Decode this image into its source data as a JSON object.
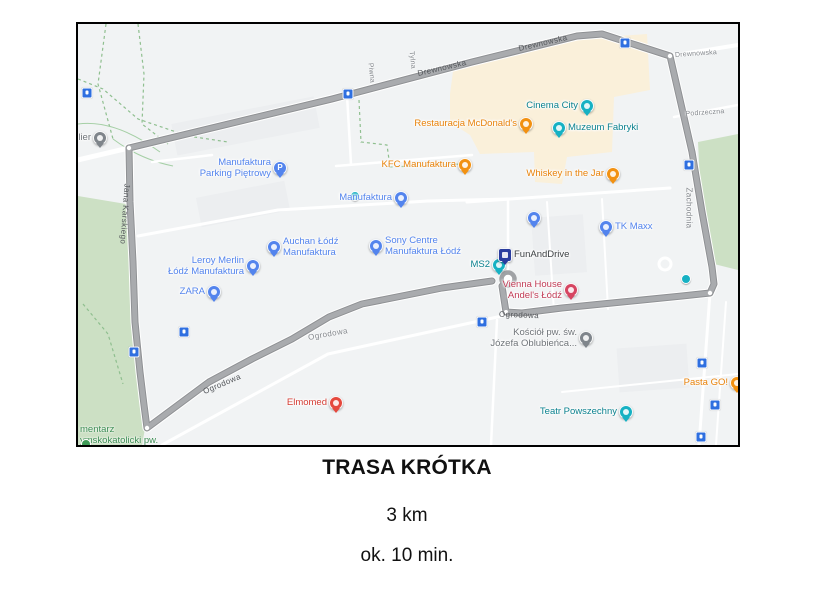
{
  "captions": {
    "title": "TRASA KRÓTKA",
    "distance": "3 km",
    "duration": "ok. 10 min."
  },
  "map": {
    "colors": {
      "background": "#f1f3f4",
      "route": "#a9abae",
      "route_casing": "#8f9194",
      "park_green": "#cce0c4",
      "commercial_cream": "#faf0da",
      "transit_blue": "#2f6fe0",
      "poi_teal": "#16b1c3",
      "poi_blue": "#5384ed",
      "poi_orange": "#f29111",
      "poi_red": "#e5483d",
      "poi_crimson": "#d64561",
      "poi_gray": "#7f858b",
      "poi_navy": "#2a3d9e",
      "poi_green": "#3f9b57"
    },
    "markers": [
      {
        "id": "atelier",
        "lines": [
          "Atelier"
        ],
        "color": "#7f858b",
        "text_color": "#6f7479",
        "x": 22,
        "y": 126,
        "side": "left"
      },
      {
        "id": "manufaktura-parking-pietrowy",
        "lines": [
          "Manufaktura",
          "Parking Piętrowy"
        ],
        "color": "#5384ed",
        "text_color": "#5384ed",
        "x": 202,
        "y": 156,
        "side": "left",
        "glyph": "P"
      },
      {
        "id": "cinema-city",
        "lines": [
          "Cinema City"
        ],
        "color": "#16b1c3",
        "text_color": "#0c828f",
        "x": 509,
        "y": 94,
        "side": "left"
      },
      {
        "id": "muzeum-fabryki",
        "lines": [
          "Muzeum Fabryki"
        ],
        "color": "#16b1c3",
        "text_color": "#0c828f",
        "x": 481,
        "y": 116,
        "side": "right"
      },
      {
        "id": "restauracja-mcdonalds",
        "lines": [
          "Restauracja McDonald's"
        ],
        "color": "#f29111",
        "text_color": "#e8820a",
        "x": 448,
        "y": 112,
        "side": "left"
      },
      {
        "id": "kfc-manufaktura",
        "lines": [
          "KFC Manufaktura"
        ],
        "color": "#f29111",
        "text_color": "#e8820a",
        "x": 387,
        "y": 153,
        "side": "left"
      },
      {
        "id": "whiskey-in-the-jar",
        "lines": [
          "Whiskey in the Jar"
        ],
        "color": "#f29111",
        "text_color": "#e8820a",
        "x": 535,
        "y": 162,
        "side": "left"
      },
      {
        "id": "manufaktura",
        "lines": [
          "Manufaktura"
        ],
        "color": "#5384ed",
        "text_color": "#5384ed",
        "x": 323,
        "y": 186,
        "side": "left"
      },
      {
        "id": "auchan-lodz-manufaktura",
        "lines": [
          "Auchan Łódź",
          "Manufaktura"
        ],
        "color": "#5384ed",
        "text_color": "#5384ed",
        "x": 196,
        "y": 235,
        "side": "right"
      },
      {
        "id": "sony-centre-manufaktura-lodz",
        "lines": [
          "Sony Centre",
          "Manufaktura Łódź"
        ],
        "color": "#5384ed",
        "text_color": "#5384ed",
        "x": 298,
        "y": 234,
        "side": "right"
      },
      {
        "id": "leroy-merlin-lodz-manufaktura",
        "lines": [
          "Leroy Merlin",
          "Łódź Manufaktura"
        ],
        "color": "#5384ed",
        "text_color": "#5384ed",
        "x": 175,
        "y": 254,
        "side": "left"
      },
      {
        "id": "zara",
        "lines": [
          "ZARA"
        ],
        "color": "#5384ed",
        "text_color": "#5384ed",
        "x": 136,
        "y": 280,
        "side": "left"
      },
      {
        "id": "tk-maxx",
        "lines": [
          "TK Maxx"
        ],
        "color": "#5384ed",
        "text_color": "#5384ed",
        "x": 528,
        "y": 215,
        "side": "right"
      },
      {
        "id": "unlabeled-shop",
        "lines": null,
        "color": "#5384ed",
        "x": 456,
        "y": 206
      },
      {
        "id": "ms2",
        "lines": [
          "MS2"
        ],
        "color": "#16b1c3",
        "text_color": "#0c828f",
        "x": 421,
        "y": 253,
        "side": "left"
      },
      {
        "id": "funanddrive",
        "lines": [
          "FunAndDrive"
        ],
        "color": "#2a3d9e",
        "text_color": "#3c4043",
        "x": 427,
        "y": 243,
        "side": "right",
        "shape": "square"
      },
      {
        "id": "vienna-house-andels-lodz",
        "lines": [
          "Vienna House",
          "Andel's Łódź"
        ],
        "color": "#d64561",
        "text_color": "#c13b55",
        "x": 493,
        "y": 278,
        "side": "left"
      },
      {
        "id": "kosciol-sw-jozefa",
        "lines": [
          "Kościół pw. św.",
          "Józefa Oblubieńca..."
        ],
        "color": "#7f858b",
        "text_color": "#6f7479",
        "x": 508,
        "y": 326,
        "side": "left"
      },
      {
        "id": "teatr-powszechny",
        "lines": [
          "Teatr Powszechny"
        ],
        "color": "#16b1c3",
        "text_color": "#0c828f",
        "x": 548,
        "y": 400,
        "side": "left"
      },
      {
        "id": "pasta-go",
        "lines": [
          "Pasta GO!"
        ],
        "color": "#f29111",
        "text_color": "#e8820a",
        "x": 659,
        "y": 371,
        "side": "left"
      },
      {
        "id": "elmomed",
        "lines": [
          "Elmomed"
        ],
        "color": "#e5483d",
        "text_color": "#d43b32",
        "x": 258,
        "y": 391,
        "side": "left"
      }
    ],
    "mini_markers": [
      {
        "id": "poi-dot-east",
        "color": "#16b1c3",
        "x": 608,
        "y": 255
      },
      {
        "id": "poi-dot-center",
        "color": "#16b1c3",
        "x": 277,
        "y": 172
      },
      {
        "id": "cemetery-dot",
        "color": "#3f9b57",
        "x": 8,
        "y": 420
      }
    ],
    "area_labels": [
      {
        "id": "cmentarz-rzymskokatolicki",
        "lines": [
          "mentarz",
          "ymskokatolicki pw."
        ],
        "color": "#3e8e55",
        "x": 2,
        "y": 401
      }
    ],
    "streets": [
      {
        "text": "Drewnowska",
        "x": 364,
        "y": 44,
        "rot": -13,
        "on": "route"
      },
      {
        "text": "Drewnowska",
        "x": 465,
        "y": 19,
        "rot": -13,
        "on": "route"
      },
      {
        "text": "Drewnowska",
        "x": 618,
        "y": 30,
        "rot": -4,
        "on": "road",
        "tiny": true
      },
      {
        "text": "Podrzeczna",
        "x": 627,
        "y": 89,
        "rot": -4,
        "on": "road",
        "tiny": true
      },
      {
        "text": "Zachodnia",
        "x": 611,
        "y": 184,
        "rot": 90,
        "on": "road"
      },
      {
        "text": "Tylna",
        "x": 334,
        "y": 36,
        "rot": 84,
        "on": "road",
        "tiny": true
      },
      {
        "text": "Piwna",
        "x": 293,
        "y": 49,
        "rot": 84,
        "on": "road",
        "tiny": true
      },
      {
        "text": "Jana Karskiego",
        "x": 47,
        "y": 190,
        "rot": 94,
        "on": "route"
      },
      {
        "text": "Ogrodowa",
        "x": 144,
        "y": 360,
        "rot": -23,
        "on": "route"
      },
      {
        "text": "Ogrodowa",
        "x": 250,
        "y": 310,
        "rot": -10,
        "on": "road"
      },
      {
        "text": "Ogrodowa",
        "x": 441,
        "y": 291,
        "rot": 2,
        "on": "route"
      }
    ],
    "transit_icons": [
      {
        "x": 9,
        "y": 69
      },
      {
        "x": 270,
        "y": 70
      },
      {
        "x": 547,
        "y": 19
      },
      {
        "x": 611,
        "y": 141
      },
      {
        "x": 56,
        "y": 328
      },
      {
        "x": 106,
        "y": 308
      },
      {
        "x": 404,
        "y": 298
      },
      {
        "x": 624,
        "y": 339
      },
      {
        "x": 637,
        "y": 381
      },
      {
        "x": 623,
        "y": 413
      }
    ]
  }
}
